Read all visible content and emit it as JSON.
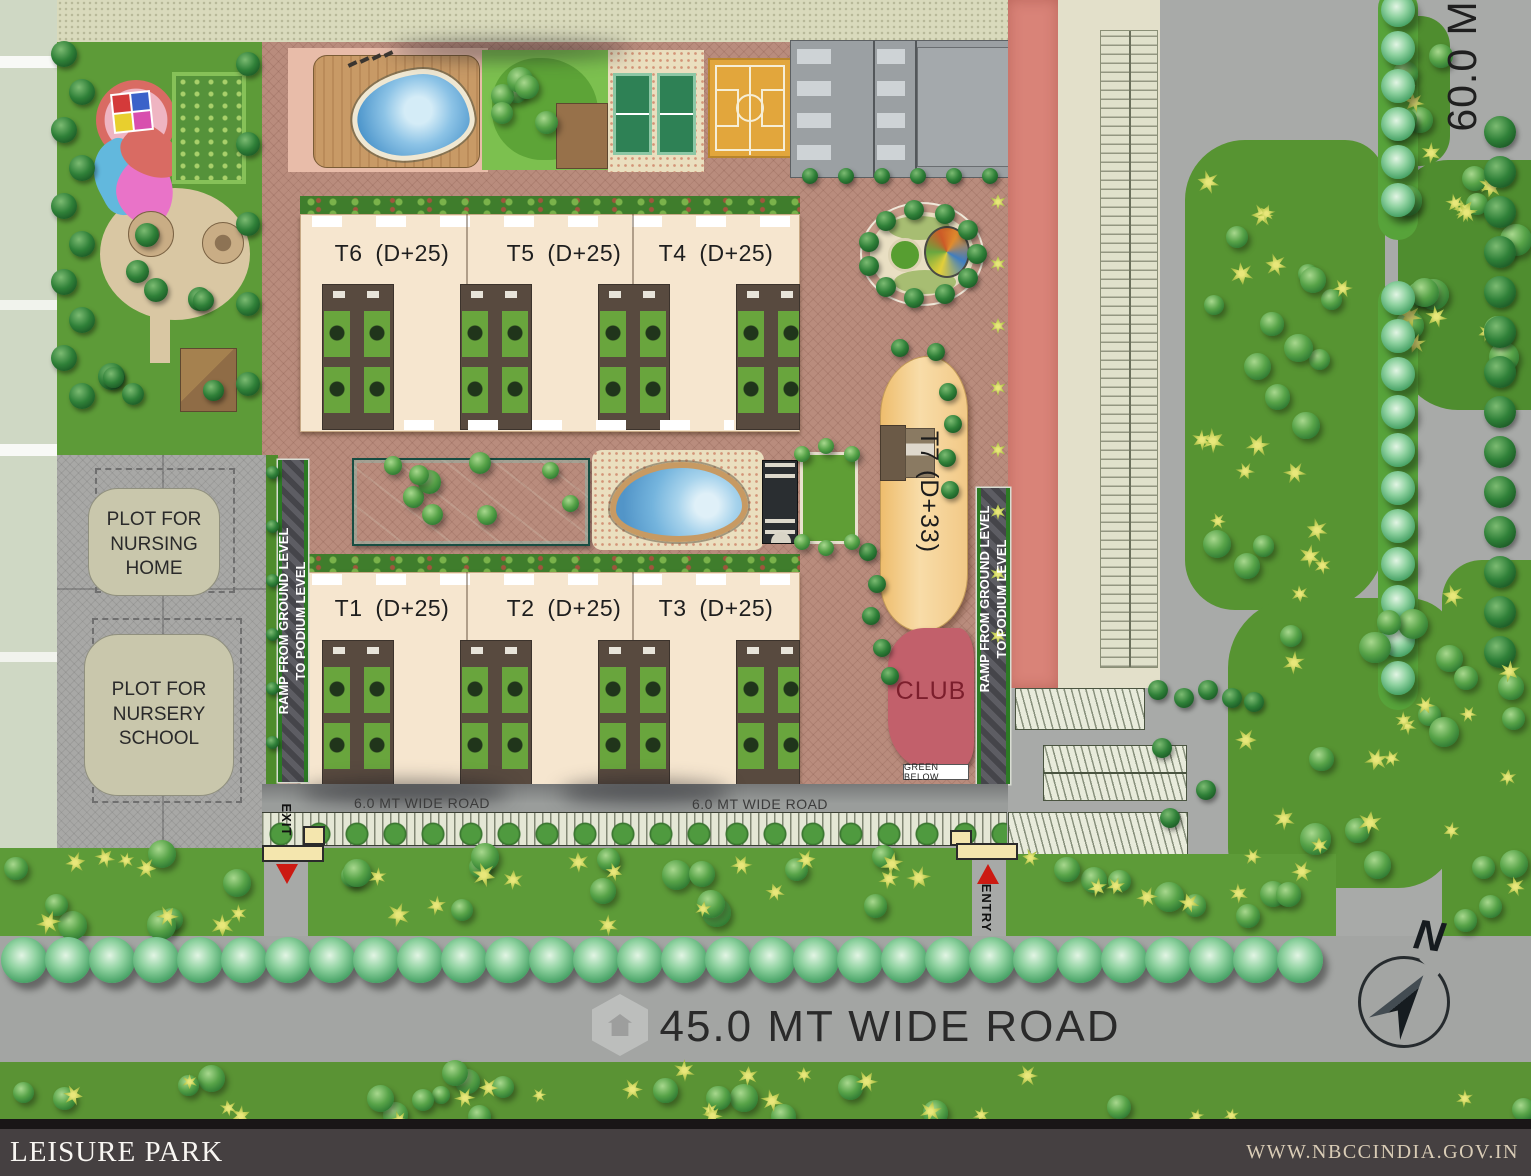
{
  "site_plan": {
    "towers_top": [
      "T6 (D+25)",
      "T5 (D+25)",
      "T4 (D+25)"
    ],
    "towers_bottom": [
      "T1 (D+25)",
      "T2 (D+25)",
      "T3 (D+25)"
    ],
    "tower_t7": "T7 (D+33)",
    "club": "CLUB",
    "green_below": "GREEN BELOW",
    "ramp_label": "RAMP FROM GROUND LEVEL\nTO PODIUM LEVEL",
    "plot_nursing_home": "PLOT FOR\nNURSING\nHOME",
    "plot_nursery_school": "PLOT FOR\nNURSERY\nSCHOOL"
  },
  "roads": {
    "inner_road_left": "6.0 MT WIDE ROAD",
    "inner_road_right": "6.0 MT WIDE ROAD",
    "main_road": "45.0 MT WIDE ROAD",
    "east_road": "60.0 M"
  },
  "gates": {
    "exit": "EXIT",
    "entry": "ENTRY"
  },
  "compass": {
    "north": "N"
  },
  "footer": {
    "project": "LEISURE PARK",
    "website": "WWW.NBCCINDIA.GOV.IN"
  },
  "colors": {
    "podium_brick": "#b98c7d",
    "tower_cream": "#f6e6cf",
    "t7_orange": "#f2c987",
    "club_pink": "#c2606b",
    "pool_blue": "#5fa8d8",
    "lawn_green": "#5d9b38",
    "salmon_road": "#d98378",
    "road_gray": "#a8aaa8",
    "plot_gray": "#a8a8a6",
    "footer_bar": "#454041"
  }
}
